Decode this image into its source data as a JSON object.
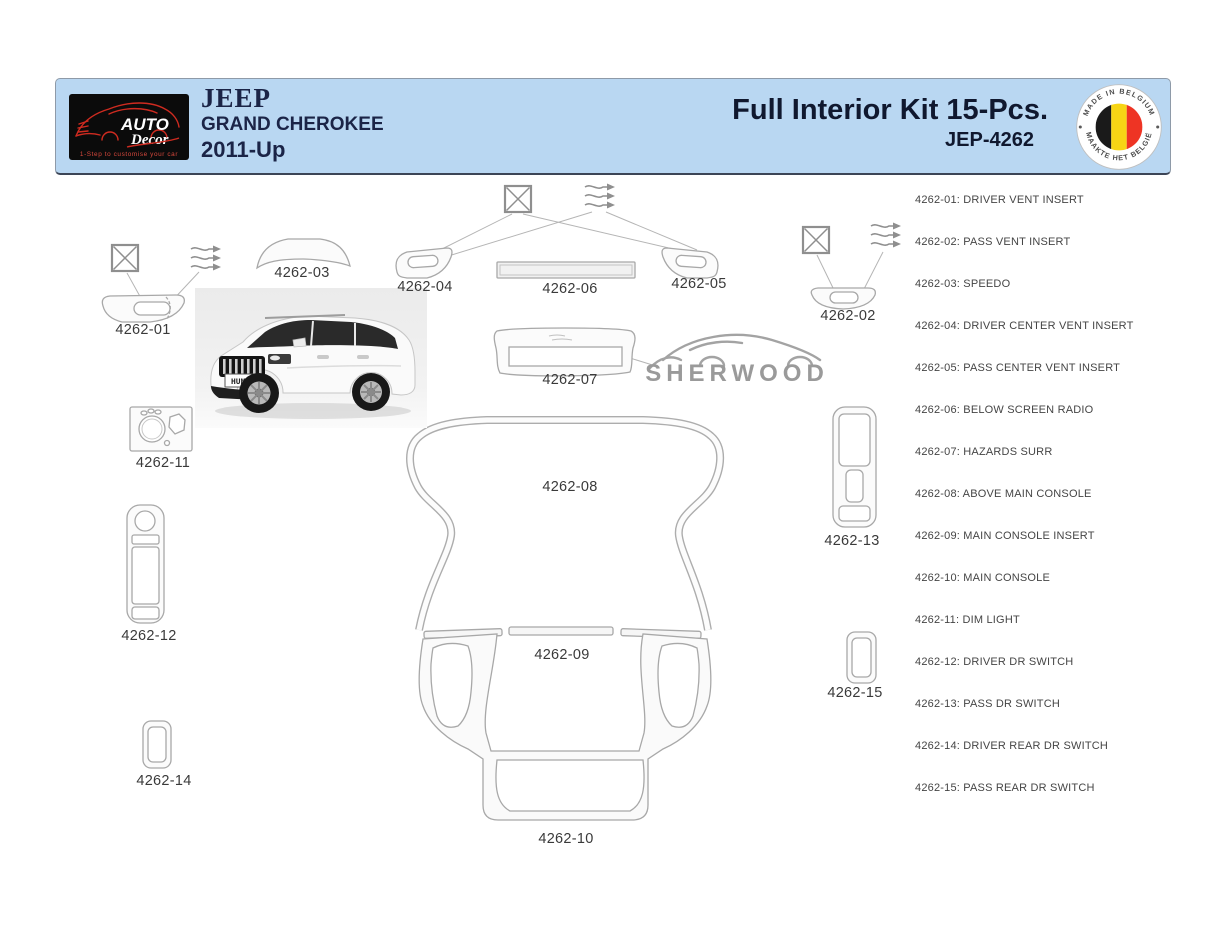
{
  "header": {
    "logo": {
      "brand_word1": "AUTO",
      "brand_word2": "Decor",
      "tagline": "1-Step to customise your car"
    },
    "vehicle_make": "JEEP",
    "vehicle_model": "GRAND CHEROKEE",
    "vehicle_year": "2011-Up",
    "kit_title": "Full Interior Kit 15-Pcs.",
    "kit_code": "JEP-4262",
    "badge_top": "MADE IN BELGIUM",
    "badge_bottom": "MAAKTE HET BELGIË"
  },
  "diagram": {
    "watermark": "SHERWOOD",
    "license_plate": "HUM3D",
    "labels": {
      "p01": "4262-01",
      "p02": "4262-02",
      "p03": "4262-03",
      "p04": "4262-04",
      "p05": "4262-05",
      "p06": "4262-06",
      "p07": "4262-07",
      "p08": "4262-08",
      "p09": "4262-09",
      "p10": "4262-10",
      "p11": "4262-11",
      "p12": "4262-12",
      "p13": "4262-13",
      "p14": "4262-14",
      "p15": "4262-15"
    }
  },
  "parts_list": {
    "items": [
      {
        "text": "4262-01: DRIVER VENT INSERT"
      },
      {
        "text": "4262-02: PASS VENT INSERT"
      },
      {
        "text": "4262-03: SPEEDO"
      },
      {
        "text": "4262-04: DRIVER CENTER VENT INSERT"
      },
      {
        "text": "4262-05: PASS CENTER VENT INSERT"
      },
      {
        "text": "4262-06: BELOW SCREEN RADIO"
      },
      {
        "text": "4262-07: HAZARDS SURR"
      },
      {
        "text": "4262-08: ABOVE MAIN CONSOLE"
      },
      {
        "text": "4262-09: MAIN CONSOLE INSERT"
      },
      {
        "text": "4262-10: MAIN CONSOLE"
      },
      {
        "text": "4262-11: DIM LIGHT"
      },
      {
        "text": "4262-12: DRIVER DR SWITCH"
      },
      {
        "text": "4262-13: PASS DR SWITCH"
      },
      {
        "text": "4262-14: DRIVER REAR DR SWITCH"
      },
      {
        "text": "4262-15: PASS REAR DR SWITCH"
      }
    ]
  },
  "colors": {
    "header_bg": "#b9d7f2",
    "title_text": "#1b2447",
    "logo_red": "#cf2b20",
    "diagram_outline": "#a8a8a8",
    "watermark_gray": "#9a9a9a",
    "flag_black": "#1a1a1a",
    "flag_yellow": "#f7d515",
    "flag_red": "#ee3424"
  }
}
